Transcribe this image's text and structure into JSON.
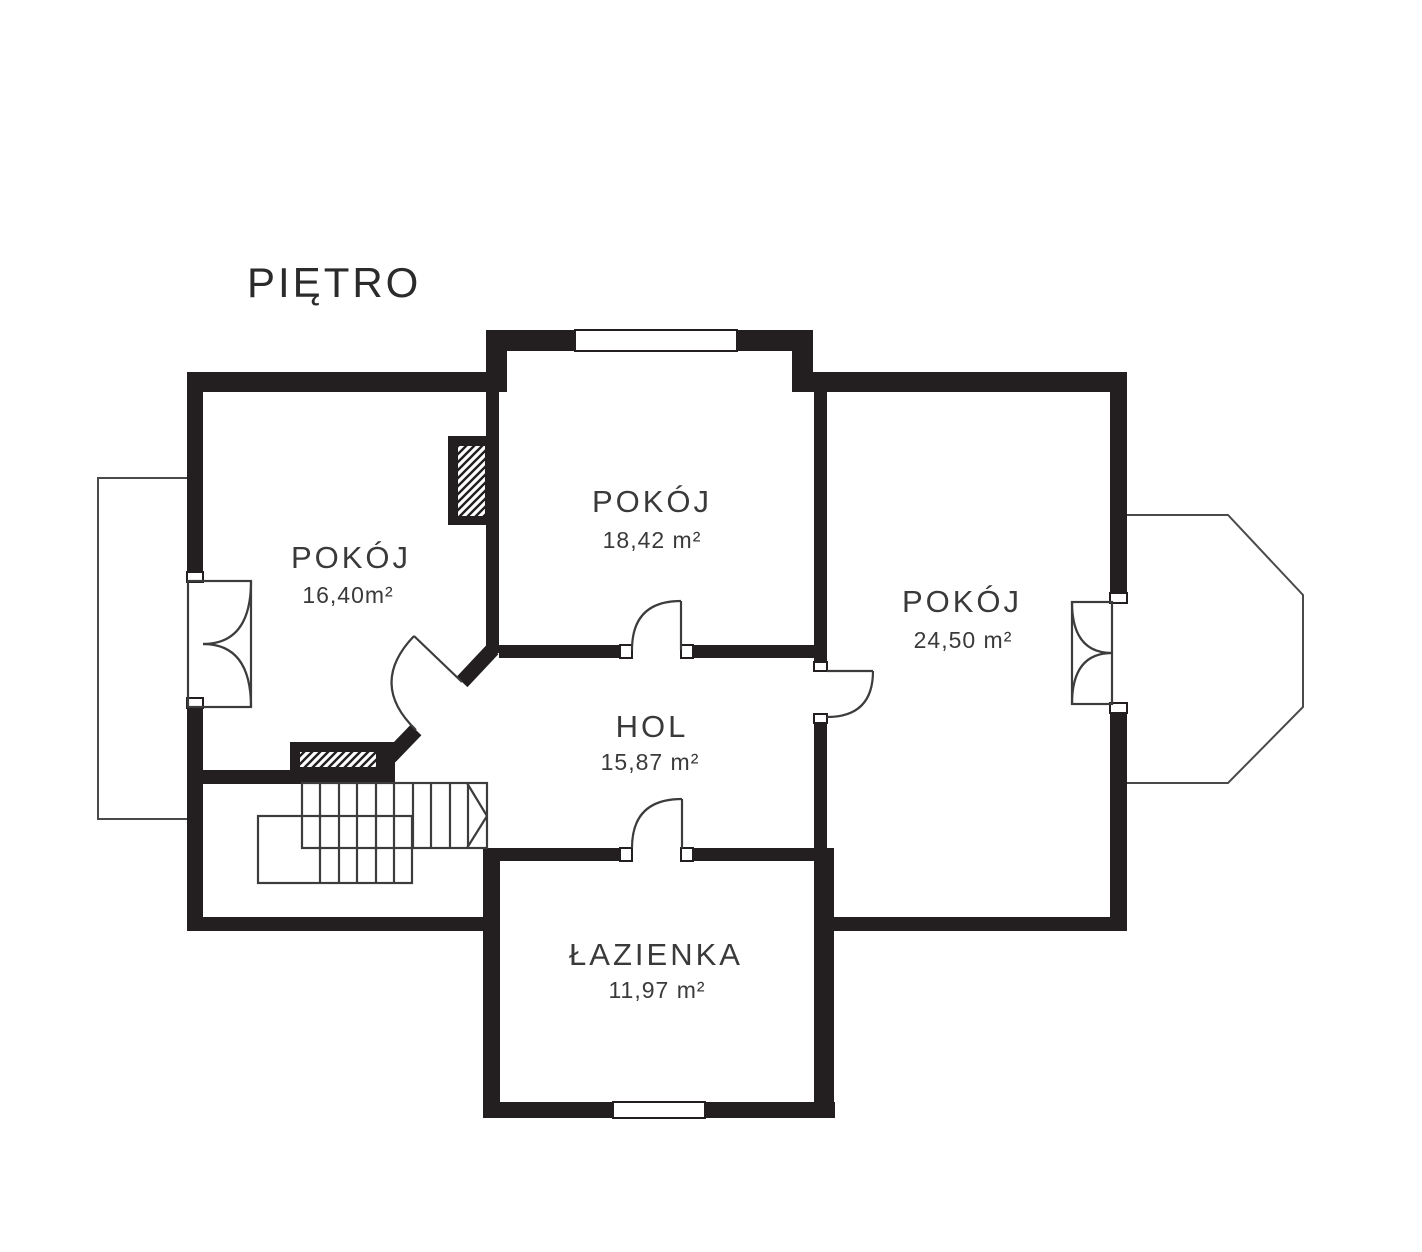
{
  "title": "PIĘTRO",
  "rooms": [
    {
      "id": "room-left",
      "name": "POKÓJ",
      "area": "16,40m²"
    },
    {
      "id": "room-top",
      "name": "POKÓJ",
      "area": "18,42 m²"
    },
    {
      "id": "room-right",
      "name": "POKÓJ",
      "area": "24,50 m²"
    },
    {
      "id": "hall",
      "name": "HOL",
      "area": "15,87 m²"
    },
    {
      "id": "bathroom",
      "name": "ŁAZIENKA",
      "area": "11,97 m²"
    }
  ],
  "colors": {
    "wall": "#231f20",
    "line": "#3c3c3c",
    "thin_outline": "#4a4a4a",
    "text": "#3a3a3a",
    "background": "#ffffff"
  }
}
